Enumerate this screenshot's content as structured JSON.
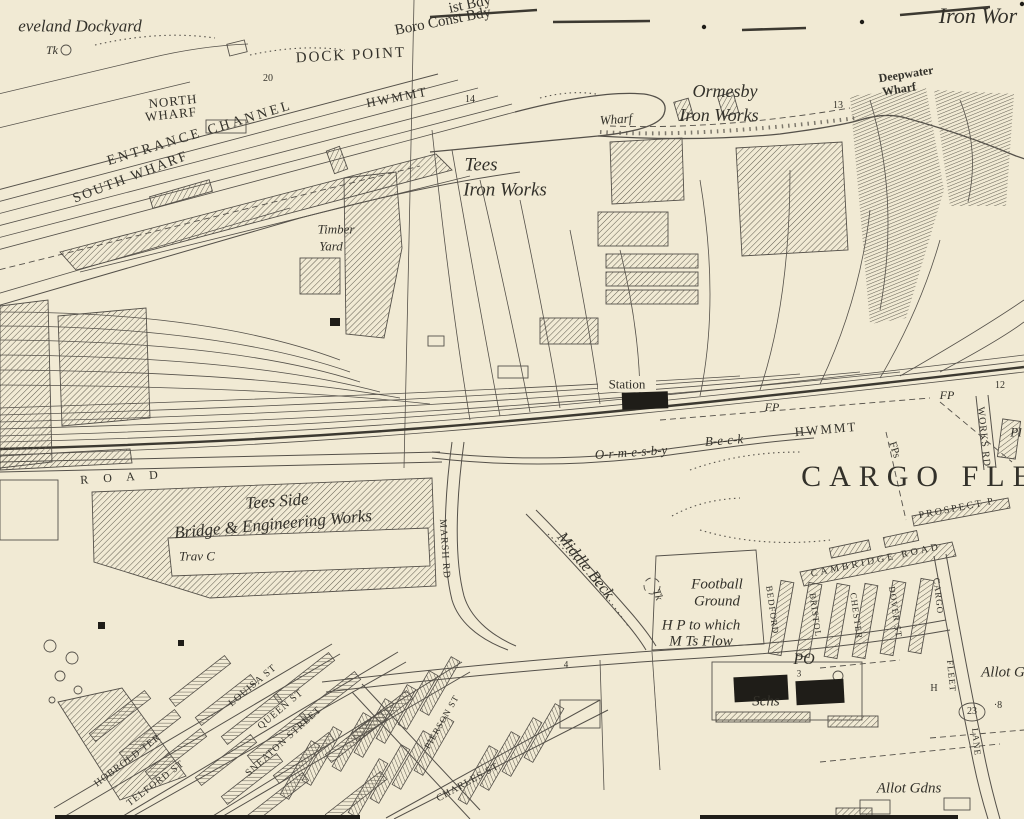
{
  "map": {
    "type": "historic-ordnance-survey-scan",
    "colors": {
      "paper": "#f1ead4",
      "ink": "#55514a",
      "text": "#33312a",
      "solid_fill": "#1f1d18"
    },
    "labels": [
      {
        "id": "cleveland-dockyard",
        "t": "eveland Dockyard",
        "x": 80,
        "y": 26,
        "s": 17,
        "c": "it"
      },
      {
        "id": "tank-abbrev-1",
        "t": "Tk",
        "x": 52,
        "y": 50,
        "s": 12,
        "c": "it"
      },
      {
        "id": "dock-point",
        "t": "DOCK POINT",
        "x": 351,
        "y": 56,
        "s": 15,
        "r": -3,
        "c": "caps",
        "ls": 2
      },
      {
        "id": "plot-20",
        "t": "20",
        "x": 268,
        "y": 79,
        "s": 10,
        "c": "num"
      },
      {
        "id": "north-wharf-1",
        "t": "NORTH",
        "x": 173,
        "y": 101,
        "s": 13,
        "r": -6,
        "c": "caps",
        "ls": 1
      },
      {
        "id": "north-wharf-2",
        "t": "WHARF",
        "x": 171,
        "y": 114,
        "s": 13,
        "r": -6,
        "c": "caps",
        "ls": 1
      },
      {
        "id": "entrance-channel",
        "t": "ENTRANCE CHANNEL",
        "x": 200,
        "y": 134,
        "s": 14,
        "r": -17,
        "c": "caps",
        "ls": 3
      },
      {
        "id": "south-wharf",
        "t": "SOUTH WHARF",
        "x": 131,
        "y": 178,
        "s": 14,
        "r": -21,
        "c": "caps",
        "ls": 2
      },
      {
        "id": "hwmmt-1",
        "t": "HWMMT",
        "x": 397,
        "y": 97,
        "s": 13,
        "r": -11,
        "c": "caps",
        "ls": 2
      },
      {
        "id": "plot-14",
        "t": "14",
        "x": 470,
        "y": 100,
        "s": 10,
        "c": "num"
      },
      {
        "id": "dist-bdy",
        "t": "ist Bdy",
        "x": 470,
        "y": 5,
        "s": 15,
        "r": -12,
        "c": "rm"
      },
      {
        "id": "boro-const-bdy",
        "t": "Boro Const Bdy",
        "x": 443,
        "y": 22,
        "s": 15,
        "r": -11,
        "c": "rm"
      },
      {
        "id": "ormesby",
        "t": "Ormesby",
        "x": 725,
        "y": 91,
        "s": 18,
        "c": "it"
      },
      {
        "id": "ormesby-iron-works",
        "t": "Iron Works",
        "x": 719,
        "y": 115,
        "s": 18,
        "c": "it"
      },
      {
        "id": "wharf-small",
        "t": "Wharf",
        "x": 616,
        "y": 119,
        "s": 13,
        "r": -4,
        "c": "it"
      },
      {
        "id": "plot-13",
        "t": "13",
        "x": 838,
        "y": 106,
        "s": 10,
        "c": "num"
      },
      {
        "id": "deepwater",
        "t": "Deepwater",
        "x": 906,
        "y": 74,
        "s": 12,
        "r": -9,
        "c": "rm b"
      },
      {
        "id": "deepwater-wharf",
        "t": "Wharf",
        "x": 899,
        "y": 89,
        "s": 12,
        "r": -9,
        "c": "rm b"
      },
      {
        "id": "iron-works-ne",
        "t": "Iron Wor",
        "x": 978,
        "y": 16,
        "s": 22,
        "c": "it"
      },
      {
        "id": "tees",
        "t": "Tees",
        "x": 481,
        "y": 165,
        "s": 19,
        "c": "it"
      },
      {
        "id": "tees-iron-works",
        "t": "Iron Works",
        "x": 505,
        "y": 190,
        "s": 19,
        "c": "it"
      },
      {
        "id": "timber",
        "t": "Timber",
        "x": 336,
        "y": 229,
        "s": 13,
        "c": "it"
      },
      {
        "id": "timber-yard",
        "t": "Yard",
        "x": 331,
        "y": 246,
        "s": 13,
        "c": "it"
      },
      {
        "id": "station",
        "t": "Station",
        "x": 627,
        "y": 384,
        "s": 13,
        "c": "rm"
      },
      {
        "id": "fp-1",
        "t": "FP",
        "x": 772,
        "y": 407,
        "s": 12,
        "c": "it"
      },
      {
        "id": "ormesby-beck-1",
        "t": "O-r-m-e-s-b-y",
        "x": 631,
        "y": 452,
        "s": 13,
        "r": -4,
        "c": "it"
      },
      {
        "id": "ormesby-beck-2",
        "t": "B-e-c-k",
        "x": 724,
        "y": 440,
        "s": 13,
        "r": -4,
        "c": "it"
      },
      {
        "id": "hwmmt-2",
        "t": "HWMMT",
        "x": 826,
        "y": 429,
        "s": 13,
        "r": -5,
        "c": "caps",
        "ls": 2
      },
      {
        "id": "fp-2",
        "t": "FP",
        "x": 947,
        "y": 395,
        "s": 12,
        "c": "it"
      },
      {
        "id": "plot-12",
        "t": "12",
        "x": 1000,
        "y": 386,
        "s": 10,
        "c": "num"
      },
      {
        "id": "works-rd",
        "t": "WORKS RD",
        "x": 983,
        "y": 437,
        "s": 10,
        "r": 84,
        "c": "caps",
        "ls": 1
      },
      {
        "id": "pl-edge",
        "t": "Pl",
        "x": 1016,
        "y": 432,
        "s": 13,
        "c": "it"
      },
      {
        "id": "cargo-fleet",
        "t": "CARGO FLE",
        "x": 920,
        "y": 477,
        "s": 30,
        "c": "caps",
        "ls": 8
      },
      {
        "id": "fps",
        "t": "FPs",
        "x": 894,
        "y": 450,
        "s": 11,
        "r": 72,
        "c": "caps"
      },
      {
        "id": "prospect-place",
        "t": "PROSPECT P",
        "x": 957,
        "y": 509,
        "s": 10,
        "r": -11,
        "c": "caps",
        "ls": 2
      },
      {
        "id": "road-spaced",
        "t": "R O A D",
        "x": 122,
        "y": 477,
        "s": 12,
        "r": -4,
        "c": "caps",
        "ls": 6
      },
      {
        "id": "tees-side",
        "t": "Tees Side",
        "x": 277,
        "y": 501,
        "s": 17,
        "r": -4,
        "c": "it"
      },
      {
        "id": "bridge-engineering-works",
        "t": "Bridge & Engineering Works",
        "x": 273,
        "y": 524,
        "s": 17,
        "r": -5,
        "c": "it"
      },
      {
        "id": "trav-c",
        "t": "Trav C",
        "x": 197,
        "y": 556,
        "s": 13,
        "c": "it"
      },
      {
        "id": "marsh-rd",
        "t": "MARSH RD",
        "x": 444,
        "y": 549,
        "s": 10,
        "r": 86,
        "c": "caps",
        "ls": 1
      },
      {
        "id": "middle-beck",
        "t": "Middle Beck",
        "x": 585,
        "y": 566,
        "s": 16,
        "r": 51,
        "c": "it"
      },
      {
        "id": "tank-abbrev-2",
        "t": "Tk",
        "x": 657,
        "y": 595,
        "s": 11,
        "r": 70,
        "c": "it"
      },
      {
        "id": "football",
        "t": "Football",
        "x": 717,
        "y": 585,
        "s": 15,
        "c": "it"
      },
      {
        "id": "football-ground",
        "t": "Ground",
        "x": 717,
        "y": 602,
        "s": 15,
        "c": "it"
      },
      {
        "id": "hp-to-which-1",
        "t": "H P to which",
        "x": 701,
        "y": 626,
        "s": 15,
        "c": "it"
      },
      {
        "id": "hp-to-which-2",
        "t": "M Ts Flow",
        "x": 701,
        "y": 642,
        "s": 15,
        "c": "it"
      },
      {
        "id": "post-office",
        "t": "PO",
        "x": 804,
        "y": 660,
        "s": 16,
        "c": "it"
      },
      {
        "id": "plot-3",
        "t": "3",
        "x": 799,
        "y": 674,
        "s": 9,
        "c": "num"
      },
      {
        "id": "schools",
        "t": "Schs",
        "x": 766,
        "y": 702,
        "s": 15,
        "c": "it"
      },
      {
        "id": "h-mark",
        "t": "H",
        "x": 934,
        "y": 689,
        "s": 10,
        "c": "caps"
      },
      {
        "id": "plot-23",
        "t": "23",
        "x": 972,
        "y": 712,
        "s": 10,
        "c": "num"
      },
      {
        "id": "plot-8",
        "t": "·8",
        "x": 998,
        "y": 706,
        "s": 10,
        "c": "num"
      },
      {
        "id": "allot-g-edge",
        "t": "Allot G",
        "x": 1003,
        "y": 673,
        "s": 15,
        "c": "it"
      },
      {
        "id": "allot-gdns",
        "t": "Allot Gdns",
        "x": 909,
        "y": 789,
        "s": 15,
        "c": "it"
      },
      {
        "id": "cambridge-road",
        "t": "CAMBRIDGE ROAD",
        "x": 876,
        "y": 561,
        "s": 10,
        "r": -12,
        "c": "caps",
        "ls": 3
      },
      {
        "id": "bedford-st",
        "t": "BEDFORD",
        "x": 772,
        "y": 610,
        "s": 9,
        "r": 82,
        "c": "caps",
        "ls": 1
      },
      {
        "id": "bristol-st",
        "t": "BRISTOL",
        "x": 815,
        "y": 615,
        "s": 9,
        "r": 82,
        "c": "caps",
        "ls": 1
      },
      {
        "id": "chester-st",
        "t": "CHESTER",
        "x": 856,
        "y": 616,
        "s": 9,
        "r": 82,
        "c": "caps",
        "ls": 1
      },
      {
        "id": "dover-st",
        "t": "DOVER ST",
        "x": 895,
        "y": 612,
        "s": 9,
        "r": 82,
        "c": "caps",
        "ls": 1
      },
      {
        "id": "cargo-lane-1",
        "t": "CARGO",
        "x": 938,
        "y": 596,
        "s": 9,
        "r": 84,
        "c": "caps",
        "ls": 1
      },
      {
        "id": "cargo-lane-2",
        "t": "FLEET",
        "x": 951,
        "y": 676,
        "s": 9,
        "r": 84,
        "c": "caps",
        "ls": 1
      },
      {
        "id": "cargo-lane-3",
        "t": "LANE",
        "x": 976,
        "y": 742,
        "s": 9,
        "r": 84,
        "c": "caps",
        "ls": 1
      },
      {
        "id": "louisa-st",
        "t": "LOUISA ST",
        "x": 253,
        "y": 686,
        "s": 10,
        "r": -40,
        "c": "caps",
        "ls": 1
      },
      {
        "id": "queen-st",
        "t": "QUEEN ST",
        "x": 281,
        "y": 710,
        "s": 10,
        "r": -40,
        "c": "caps",
        "ls": 1
      },
      {
        "id": "sneaton-street",
        "t": "SNEATON STREET",
        "x": 284,
        "y": 742,
        "s": 10,
        "r": -42,
        "c": "caps",
        "ls": 1
      },
      {
        "id": "hobrold-ter",
        "t": "HOBROLD TER",
        "x": 128,
        "y": 761,
        "s": 10,
        "r": -37,
        "c": "caps",
        "ls": 1
      },
      {
        "id": "telford-st",
        "t": "TELFORD ST",
        "x": 156,
        "y": 784,
        "s": 10,
        "r": -37,
        "c": "caps",
        "ls": 1
      },
      {
        "id": "charles-st",
        "t": "CHARLES ST",
        "x": 468,
        "y": 783,
        "s": 10,
        "r": -29,
        "c": "caps",
        "ls": 1
      },
      {
        "id": "pierson-st",
        "t": "PIERSON ST",
        "x": 442,
        "y": 722,
        "s": 9,
        "r": -60,
        "c": "caps",
        "ls": 1
      },
      {
        "id": "plot-4",
        "t": "4",
        "x": 566,
        "y": 665,
        "s": 9,
        "c": "num"
      }
    ]
  }
}
